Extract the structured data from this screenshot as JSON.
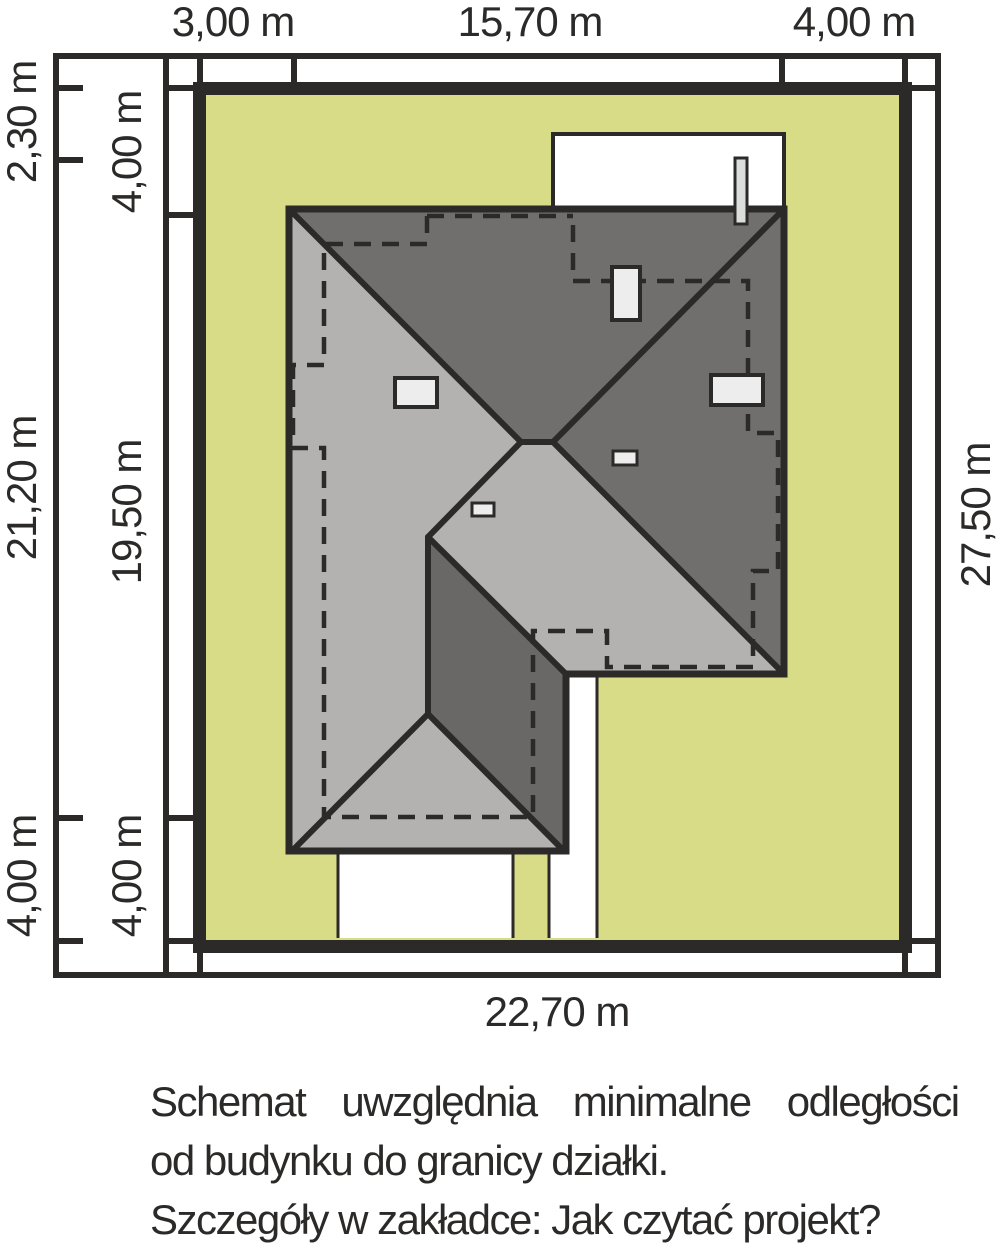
{
  "dims": {
    "top": [
      "3,00 m",
      "15,70 m",
      "4,00 m"
    ],
    "left_outer": [
      "2,30 m",
      "21,20 m",
      "4,00 m"
    ],
    "left_inner": [
      "4,00 m",
      "19,50 m",
      "4,00 m"
    ],
    "right": "27,50 m",
    "bottom": "22,70 m"
  },
  "caption": {
    "line1": "Schemat uwzględnia minimalne odległości",
    "line2": "od budynku do granicy działki.",
    "line3": "Szczegóły w zakładce: Jak czytać projekt?"
  },
  "colors": {
    "plot_green": "#d8dc86",
    "roof_light": "#b3b2b1",
    "roof_dark": "#716f6e",
    "roof_dark_lower": "#696867",
    "line_black": "#2b2a29",
    "skylight": "#ecedec",
    "chimney": "#dcdddd",
    "background": "#ffffff"
  }
}
